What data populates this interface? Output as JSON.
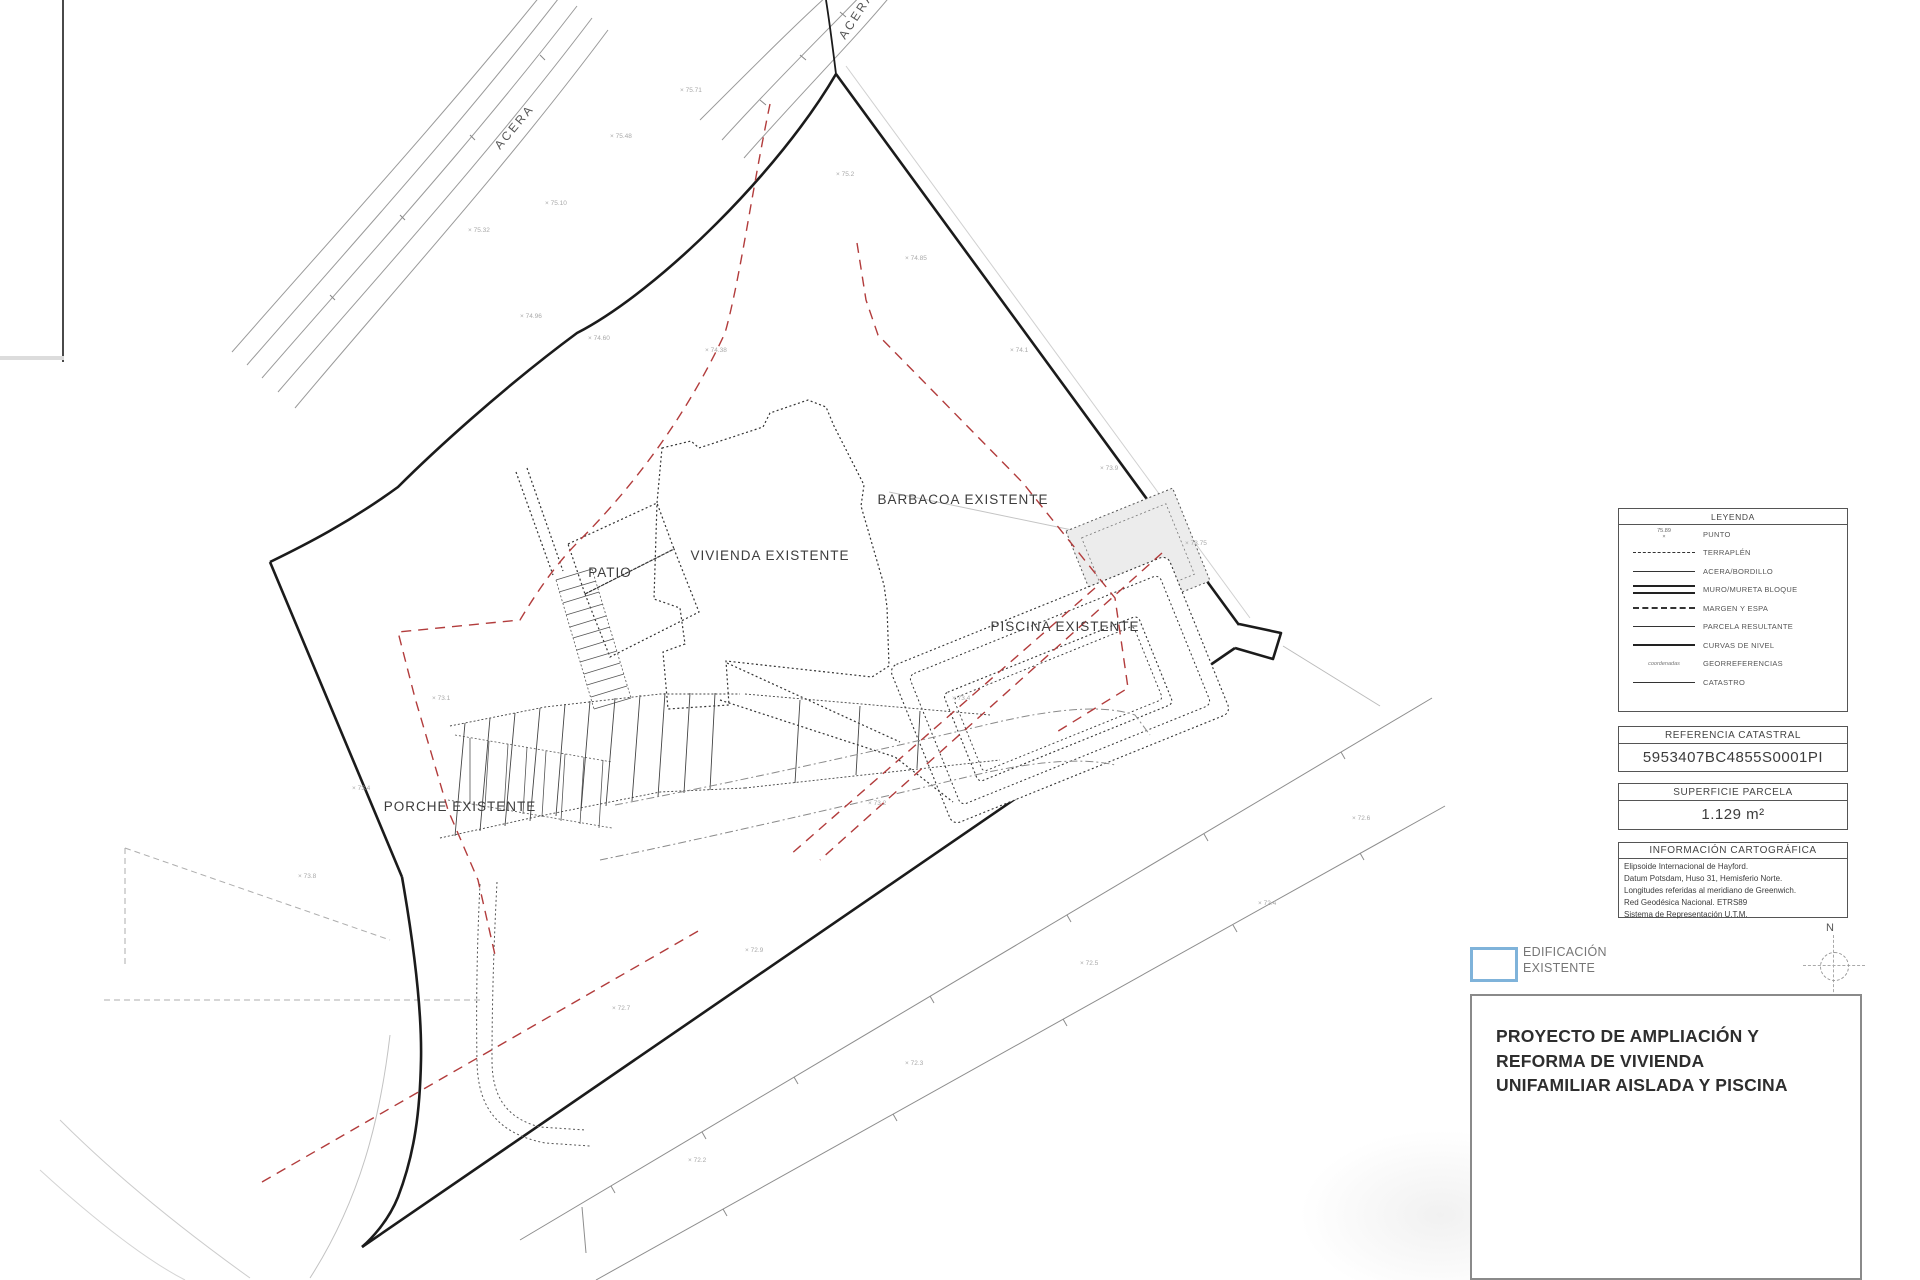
{
  "plan": {
    "labels": {
      "acera_road": "ACERA",
      "acera_top": "ACERA",
      "vivienda": "VIVIENDA EXISTENTE",
      "patio": "PATIO",
      "barbacoa": "BARBACOA EXISTENTE",
      "piscina": "PISCINA EXISTENTE",
      "porche": "PORCHE EXISTENTE"
    },
    "survey_marks": [
      {
        "x": 468,
        "y": 232,
        "v": "75.32"
      },
      {
        "x": 545,
        "y": 205,
        "v": "75.10"
      },
      {
        "x": 610,
        "y": 138,
        "v": "75.48"
      },
      {
        "x": 680,
        "y": 92,
        "v": "75.71"
      },
      {
        "x": 520,
        "y": 318,
        "v": "74.96"
      },
      {
        "x": 588,
        "y": 340,
        "v": "74.60"
      },
      {
        "x": 705,
        "y": 352,
        "v": "74.38"
      },
      {
        "x": 836,
        "y": 176,
        "v": "75.2"
      },
      {
        "x": 905,
        "y": 260,
        "v": "74.85"
      },
      {
        "x": 1010,
        "y": 352,
        "v": "74.1"
      },
      {
        "x": 1100,
        "y": 470,
        "v": "73.9"
      },
      {
        "x": 1185,
        "y": 545,
        "v": "73.75"
      },
      {
        "x": 952,
        "y": 700,
        "v": "73.4"
      },
      {
        "x": 868,
        "y": 805,
        "v": "73.2"
      },
      {
        "x": 745,
        "y": 952,
        "v": "72.9"
      },
      {
        "x": 612,
        "y": 1010,
        "v": "72.7"
      },
      {
        "x": 432,
        "y": 700,
        "v": "73.1"
      },
      {
        "x": 352,
        "y": 790,
        "v": "73.4"
      },
      {
        "x": 298,
        "y": 878,
        "v": "73.8"
      },
      {
        "x": 1258,
        "y": 905,
        "v": "72.4"
      },
      {
        "x": 1352,
        "y": 820,
        "v": "72.6"
      },
      {
        "x": 688,
        "y": 1162,
        "v": "72.2"
      },
      {
        "x": 905,
        "y": 1065,
        "v": "72.3"
      },
      {
        "x": 1080,
        "y": 965,
        "v": "72.5"
      }
    ]
  },
  "panel": {
    "legend": {
      "title": "LEYENDA",
      "punto_symbol": "75.89",
      "geo_symbol": "coordenadas",
      "rows": [
        {
          "label": "PUNTO"
        },
        {
          "label": "TERRAPLÉN"
        },
        {
          "label": "ACERA/BORDILLO"
        },
        {
          "label": "MURO/MURETA BLOQUE"
        },
        {
          "label": "MARGEN Y ESPA"
        },
        {
          "label": "PARCELA RESULTANTE"
        },
        {
          "label": "CURVAS DE NIVEL"
        },
        {
          "label": "GEORREFERENCIAS"
        },
        {
          "label": "CATASTRO"
        }
      ]
    },
    "catastral": {
      "header": "REFERENCIA CATASTRAL",
      "value": "5953407BC4855S0001PI"
    },
    "superficie": {
      "header": "SUPERFICIE PARCELA",
      "value": "1.129 m²"
    },
    "cartografia": {
      "header": "INFORMACIÓN CARTOGRÁFICA",
      "lines": [
        "Elipsoide Internacional de Hayford.",
        "Datum Potsdam, Huso 31, Hemisferio Norte.",
        "Longitudes referidas al meridiano de Greenwich.",
        "Red Geodésica Nacional. ETRS89",
        "Sistema de Representación U.T.M."
      ]
    },
    "edificacion": {
      "line1": "EDIFICACIÓN",
      "line2": "EXISTENTE"
    },
    "north_label": "N",
    "title_block": {
      "line1": "PROYECTO DE AMPLIACIÓN Y",
      "line2": "REFORMA DE VIVIENDA",
      "line3": "UNIFAMILIAR AISLADA Y PISCINA"
    },
    "colors": {
      "accent_blue": "#7fb3da",
      "red_overlay": "#b23c3c"
    }
  }
}
